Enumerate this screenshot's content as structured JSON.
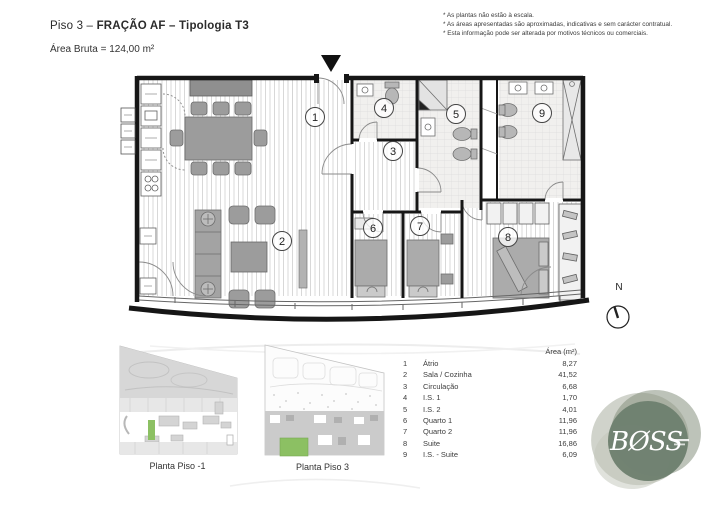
{
  "header": {
    "title_prefix": "Piso 3 – ",
    "title_bold": "FRAÇÃO AF – Tipologia T3",
    "subtitle": "Área Bruta = 124,00 m²"
  },
  "disclaimers": [
    "* As plantas não estão à escala.",
    "* As áreas apresentadas são aproximadas, indicativas e sem carácter contratual.",
    "* Esta informação pode ser alterada por motivos técnicos ou comerciais."
  ],
  "plan": {
    "rooms": [
      {
        "number": "1"
      },
      {
        "number": "2"
      },
      {
        "number": "3"
      },
      {
        "number": "4"
      },
      {
        "number": "5"
      },
      {
        "number": "6"
      },
      {
        "number": "7"
      },
      {
        "number": "8"
      },
      {
        "number": "9"
      }
    ]
  },
  "compass": {
    "label": "N"
  },
  "legend": {
    "header": "Área (m²)",
    "rows": [
      {
        "num": "1",
        "name": "Átrio",
        "area": "8,27"
      },
      {
        "num": "2",
        "name": "Sala / Cozinha",
        "area": "41,52"
      },
      {
        "num": "3",
        "name": "Circulação",
        "area": "6,68"
      },
      {
        "num": "4",
        "name": "I.S. 1",
        "area": "1,70"
      },
      {
        "num": "5",
        "name": "I.S. 2",
        "area": "4,01"
      },
      {
        "num": "6",
        "name": "Quarto 1",
        "area": "11,96"
      },
      {
        "num": "7",
        "name": "Quarto 2",
        "area": "11,96"
      },
      {
        "num": "8",
        "name": "Suite",
        "area": "16,86"
      },
      {
        "num": "9",
        "name": "I.S. - Suite",
        "area": "6,09"
      }
    ]
  },
  "thumbnails": {
    "left": {
      "label": "Planta Piso -1"
    },
    "right": {
      "label": "Planta Piso 3"
    }
  },
  "logo": {
    "text": "BØSS"
  },
  "colors": {
    "highlight_green": "#8cc063",
    "logo_green": "#6e8070",
    "wall": "#161616"
  }
}
